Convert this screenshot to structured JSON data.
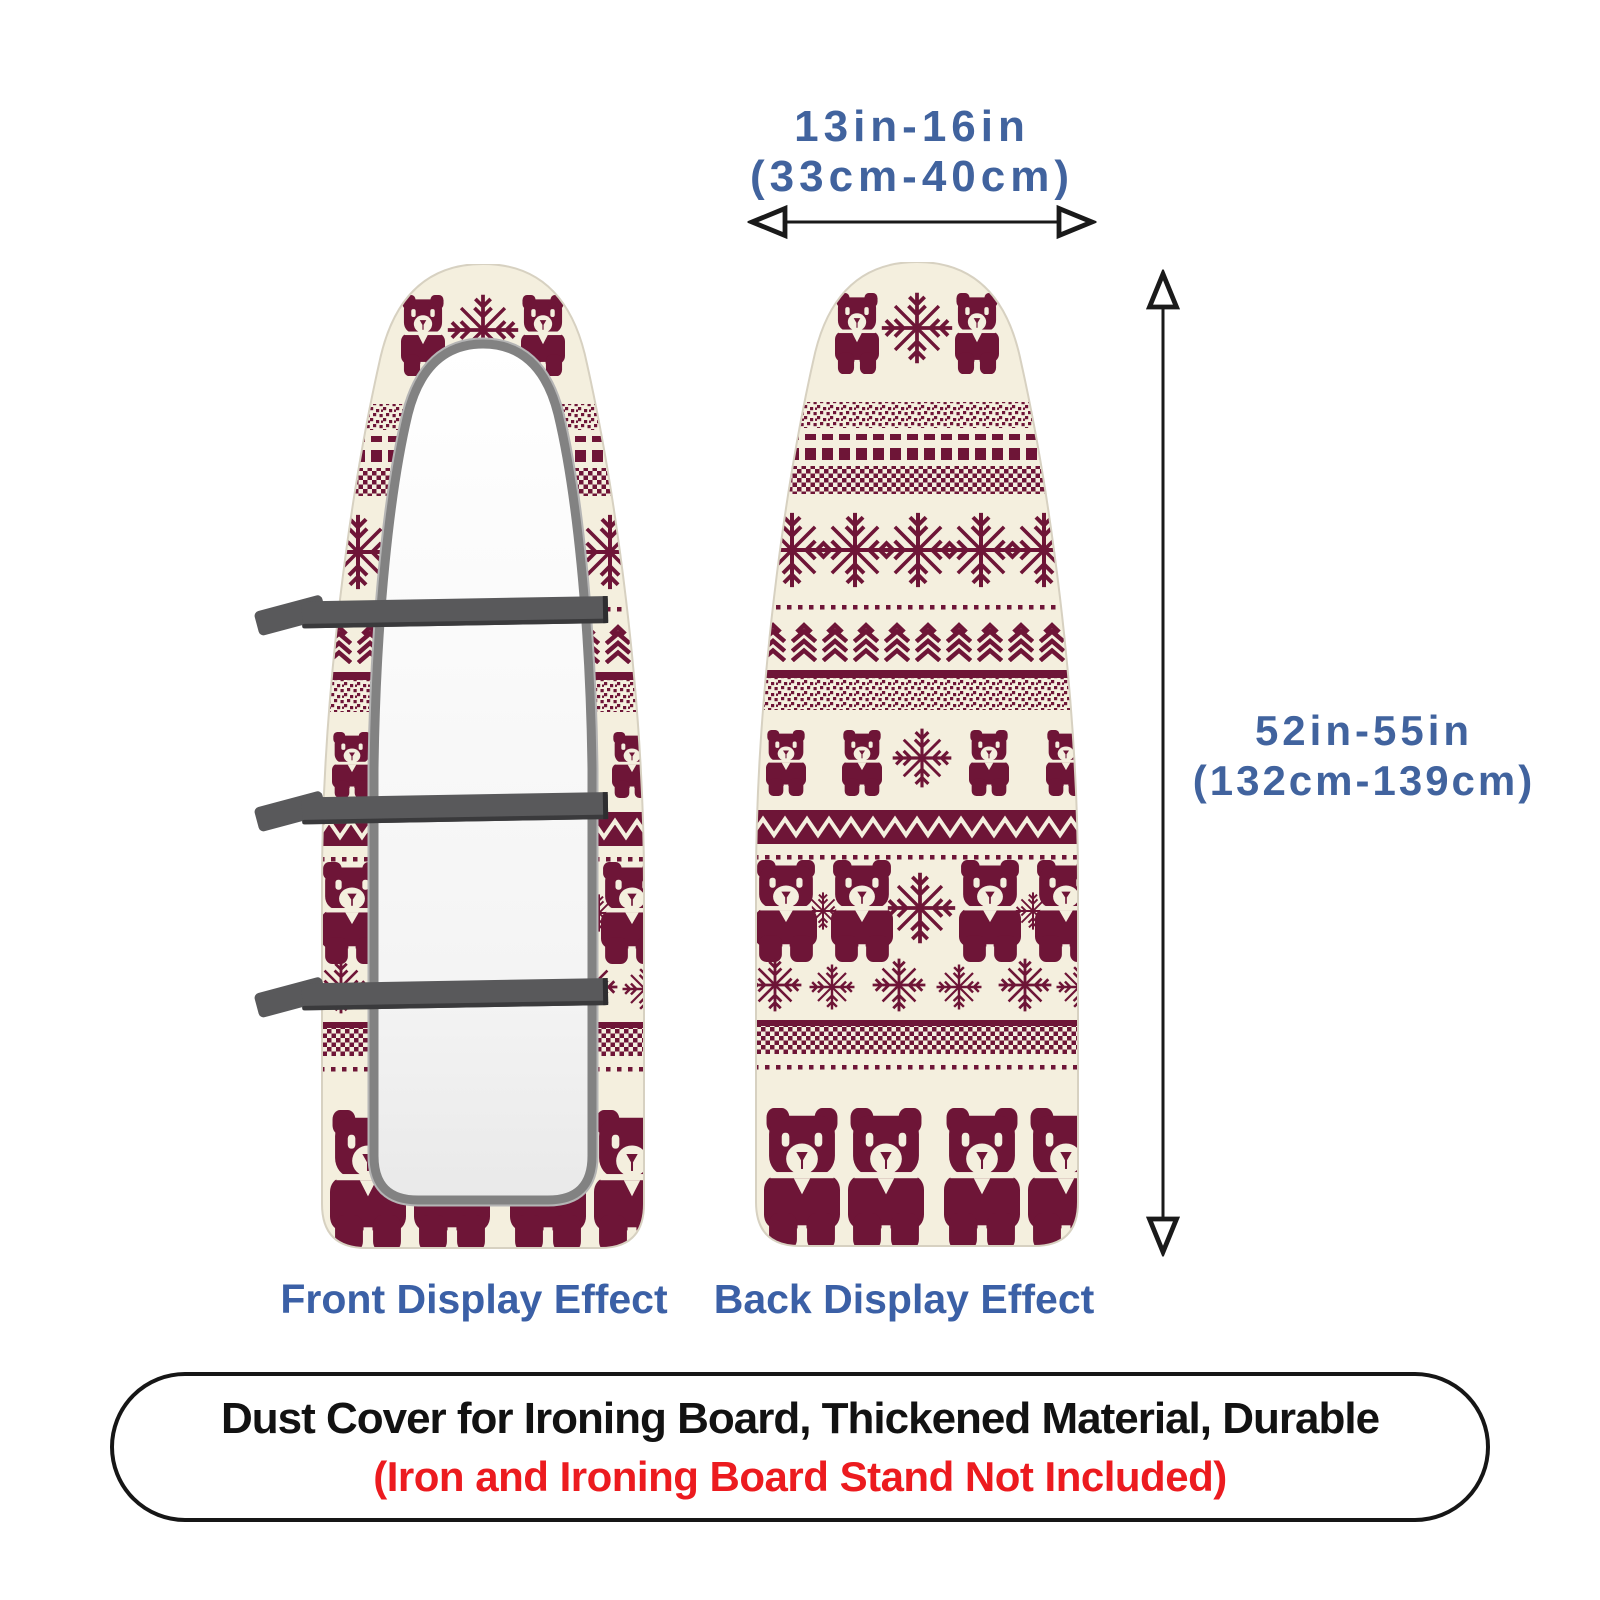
{
  "top_dimension": {
    "line1": "13in-16in",
    "line2": "(33cm-40cm)"
  },
  "side_dimension": {
    "line1": "52in-55in",
    "line2": "(132cm-139cm)"
  },
  "views": {
    "front_label": "Front Display Effect",
    "back_label": "Back Display Effect"
  },
  "caption": {
    "line1": "Dust Cover for Ironing Board, Thickened Material, Durable",
    "line2": "(Iron and Ironing Board Stand Not Included)"
  },
  "pattern": {
    "style": "fair-isle knit, maroon on cream",
    "motifs": [
      "teddy-bear",
      "snowflake",
      "pine-branch",
      "zigzag-band",
      "checker-band",
      "speckle-band",
      "dot-line"
    ],
    "front_view_parts": [
      "pattern border",
      "gray piping",
      "white underside",
      "3 elastic straps"
    ]
  },
  "colors": {
    "dimension_text": "#41639e",
    "label_text": "#3b60a6",
    "caption_text": "#121212",
    "caption_highlight": "#ec1b1f",
    "pattern_maroon": "#6e1537",
    "fabric_cream": "#f4efde",
    "strap_gray": "#59595b",
    "piping_gray": "#828282",
    "board_edge": "#d7d1c1",
    "arrow_black": "#1a1a1a"
  }
}
